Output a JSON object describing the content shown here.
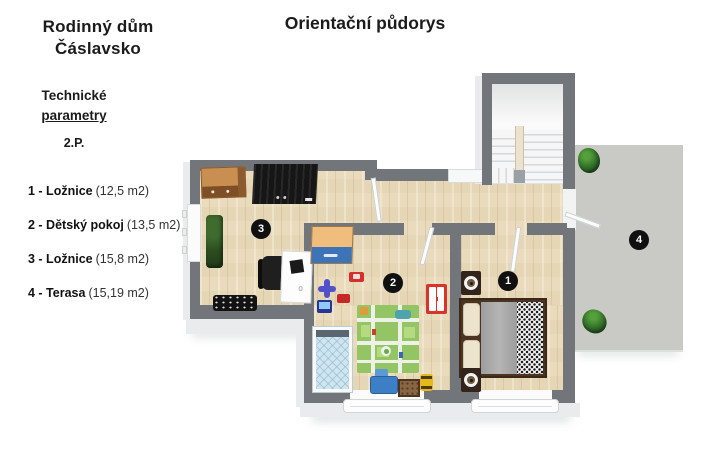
{
  "header": {
    "title": "Orientační půdorys"
  },
  "sidebar": {
    "title_line1": "Rodinný dům",
    "title_line2": "Čáslavsko",
    "subtitle_line1": "Technické",
    "subtitle_line2": "parametry",
    "floor_label": "2.P.",
    "legend": [
      {
        "label": "1 - Ložnice",
        "area": "(12,5 m2)"
      },
      {
        "label": "2 - Dětský pokoj",
        "area": "(13,5 m2)"
      },
      {
        "label": "3 - Ložnice",
        "area": "(15,8 m2)"
      },
      {
        "label": "4 - Terasa",
        "area": "(15,19 m2)"
      }
    ]
  },
  "floorplan": {
    "markers": [
      {
        "num": "1"
      },
      {
        "num": "2"
      },
      {
        "num": "3"
      },
      {
        "num": "4"
      }
    ],
    "colors": {
      "wall": "#72767b",
      "wall_face": "#e9ebec",
      "floor_wood": "#e9dbbc",
      "terrace": "#c9cac5",
      "stairs": "#f6f6f6",
      "marker_bg": "#101010",
      "marker_text": "#ffffff"
    }
  }
}
